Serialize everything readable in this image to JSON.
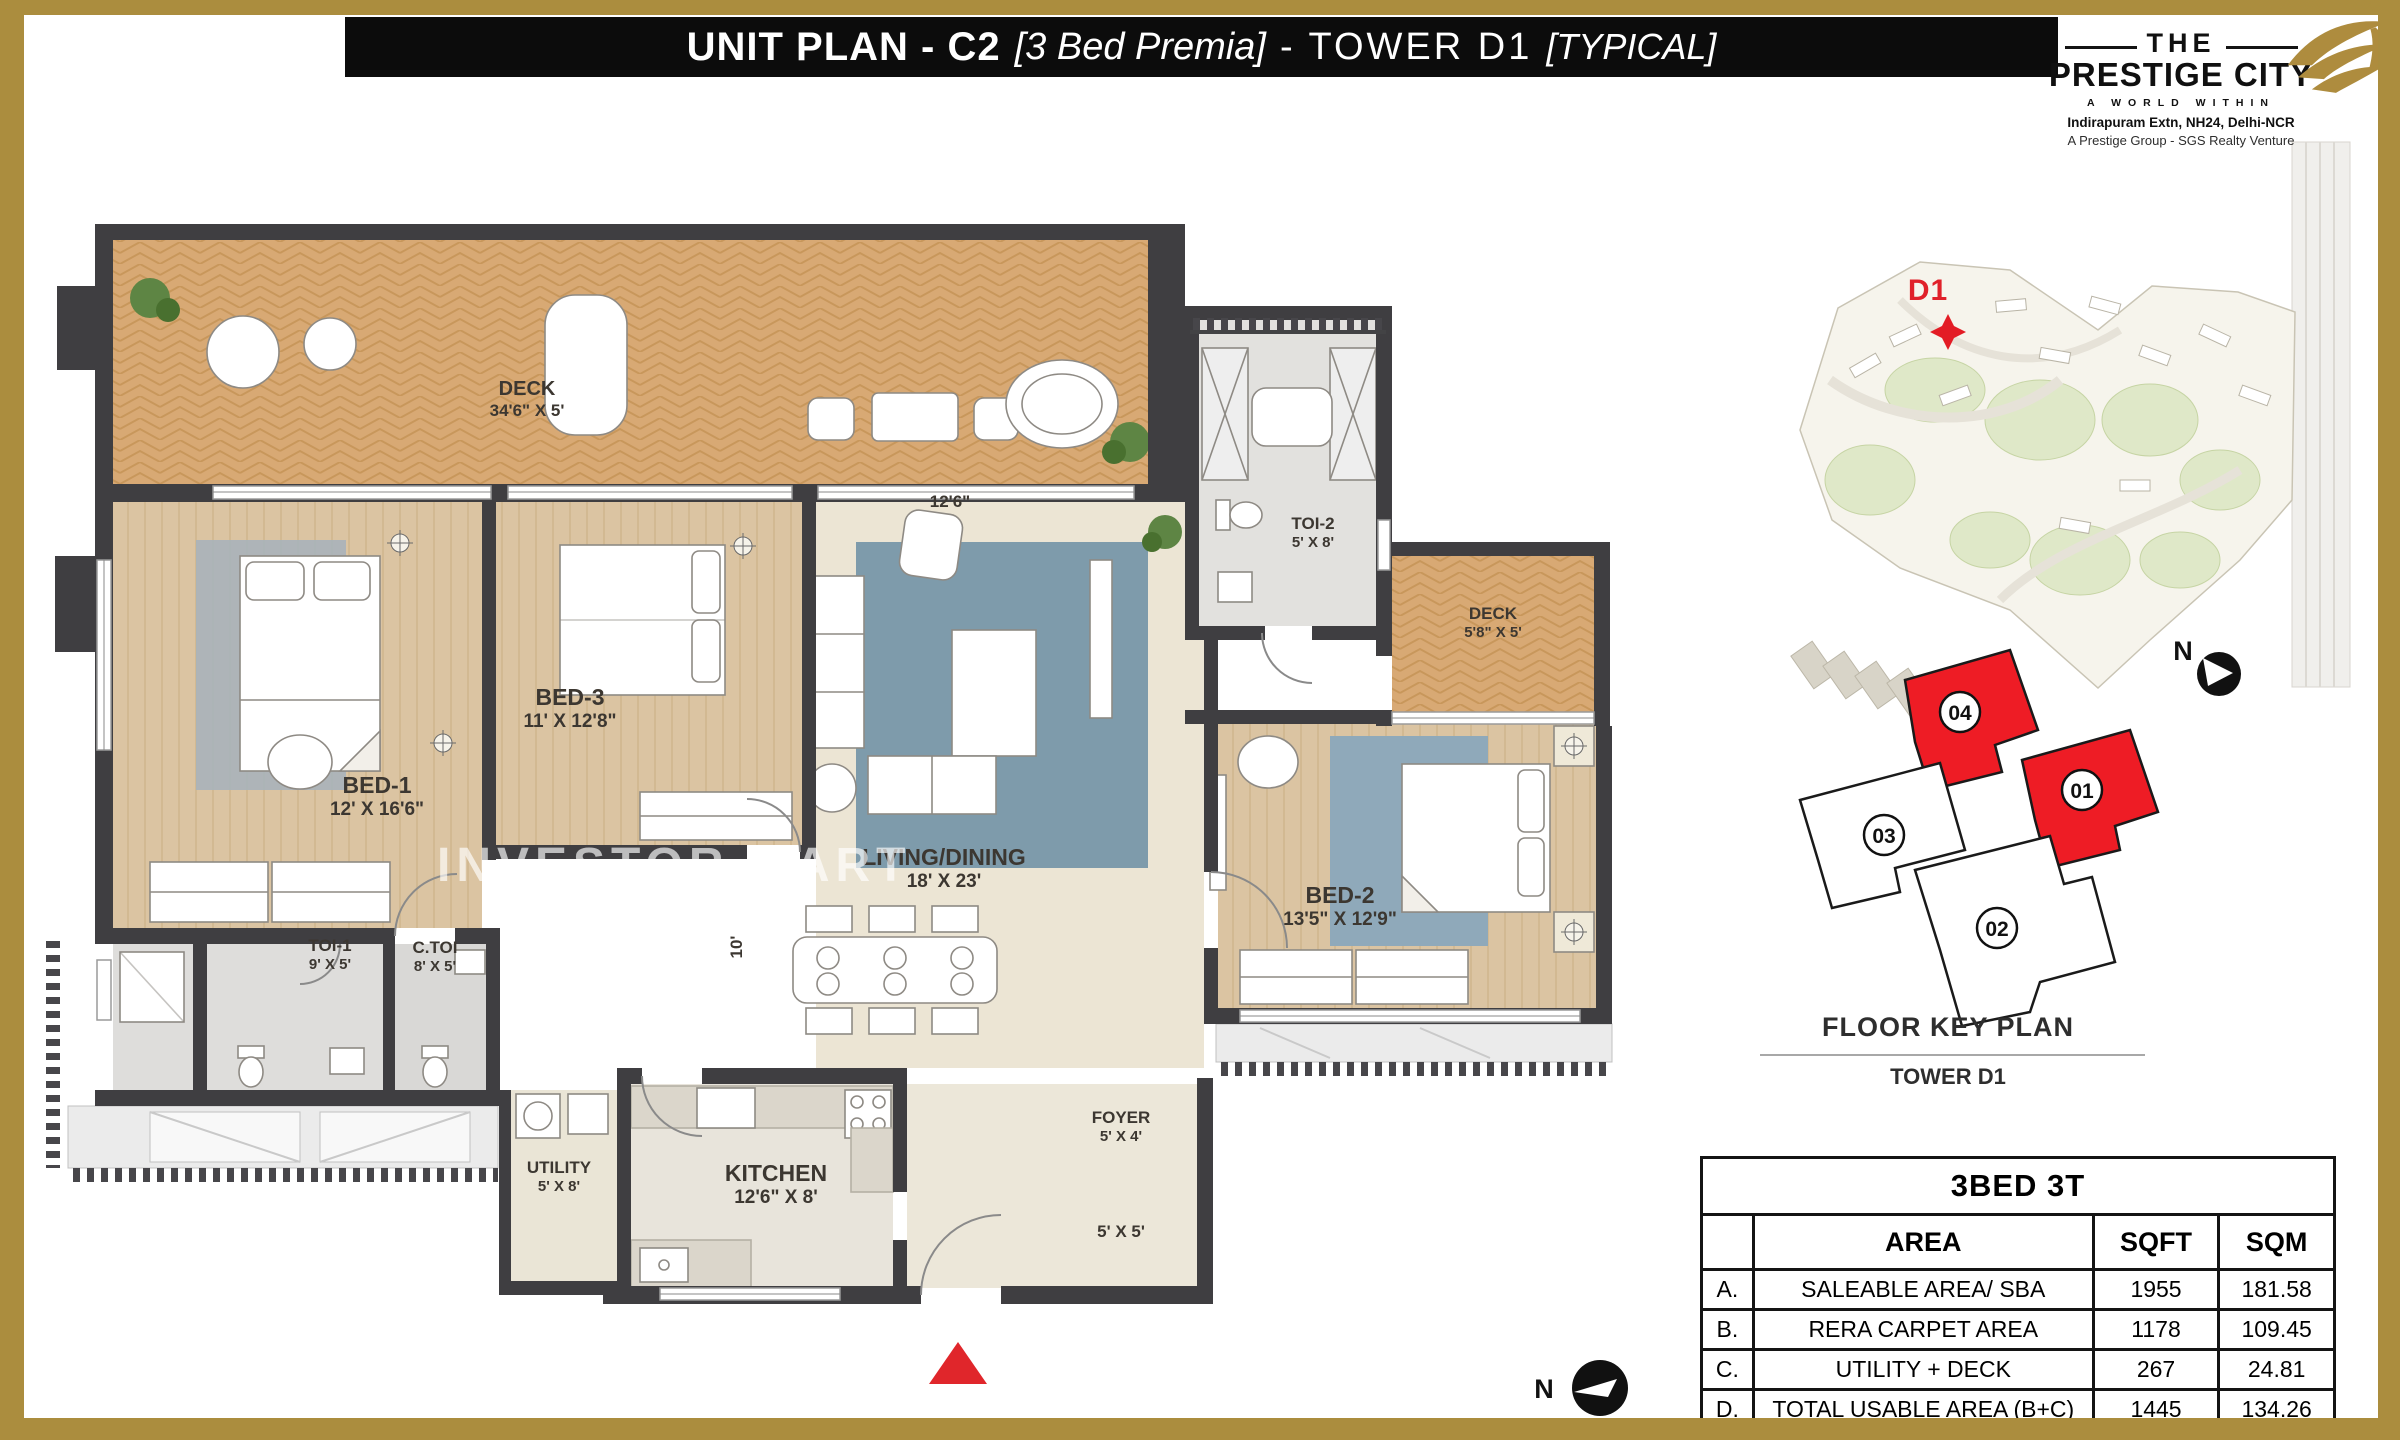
{
  "page": {
    "colors": {
      "gold_frame": "#ab8d3e",
      "title_bg": "#0c0c0c",
      "wall": "#3f3e41",
      "accent_red": "#e0262b",
      "keyplan_red": "#ee1c25",
      "deck_wood": "#d8a974"
    }
  },
  "title_bar": {
    "segment1": "UNIT PLAN - C2",
    "segment2": "[3 Bed Premia]",
    "segment3": "- TOWER D1",
    "segment4": "[TYPICAL]"
  },
  "logo": {
    "line1": "THE",
    "line2": "PRESTIGE CITY",
    "line3": "A WORLD WITHIN",
    "line4": "Indirapuram Extn, NH24, Delhi-NCR",
    "line5": "A Prestige Group - SGS Realty Venture"
  },
  "site_map": {
    "tower_label": "D1"
  },
  "key_plan": {
    "title": "FLOOR KEY PLAN",
    "subtitle": "TOWER D1",
    "north_label": "N",
    "units": [
      {
        "label": "04",
        "highlighted": true
      },
      {
        "label": "01",
        "highlighted": true
      },
      {
        "label": "03",
        "highlighted": false
      },
      {
        "label": "02",
        "highlighted": false
      }
    ]
  },
  "floor_plan": {
    "watermark": "INVESTOR MART",
    "north_label": "N",
    "rooms": [
      {
        "name": "DECK",
        "dim": "34'6\" X 5'"
      },
      {
        "name": "BED-1",
        "dim": "12' X 16'6\""
      },
      {
        "name": "BED-3",
        "dim": "11' X 12'8\""
      },
      {
        "name": "LIVING/DINING",
        "dim": "18' X 23'"
      },
      {
        "name": "TOI-2",
        "dim": "5' X 8'"
      },
      {
        "name": "DECK",
        "dim": "5'8\" X 5'"
      },
      {
        "name": "BED-2",
        "dim": "13'5\" X 12'9\""
      },
      {
        "name": "TOI-1",
        "dim": "9' X 5'"
      },
      {
        "name": "C.TOI",
        "dim": "8' X 5'"
      },
      {
        "name": "UTILITY",
        "dim": "5' X 8'"
      },
      {
        "name": "KITCHEN",
        "dim": "12'6\" X 8'"
      },
      {
        "name": "FOYER",
        "dim": "5' X 4'"
      }
    ],
    "extra_dims": {
      "living_top": "12'6\"",
      "dining_side": "10'",
      "foyer_south": "5' X 5'"
    }
  },
  "area_table": {
    "title": "3BED 3T",
    "columns": [
      "AREA",
      "SQFT",
      "SQM"
    ],
    "rows": [
      {
        "key": "A.",
        "area": "SALEABLE AREA/ SBA",
        "sqft": "1955",
        "sqm": "181.58"
      },
      {
        "key": "B.",
        "area": "RERA CARPET AREA",
        "sqft": "1178",
        "sqm": "109.45"
      },
      {
        "key": "C.",
        "area": "UTILITY + DECK",
        "sqft": "267",
        "sqm": "24.81"
      },
      {
        "key": "D.",
        "area": "TOTAL USABLE AREA (B+C)",
        "sqft": "1445",
        "sqm": "134.26"
      }
    ]
  }
}
